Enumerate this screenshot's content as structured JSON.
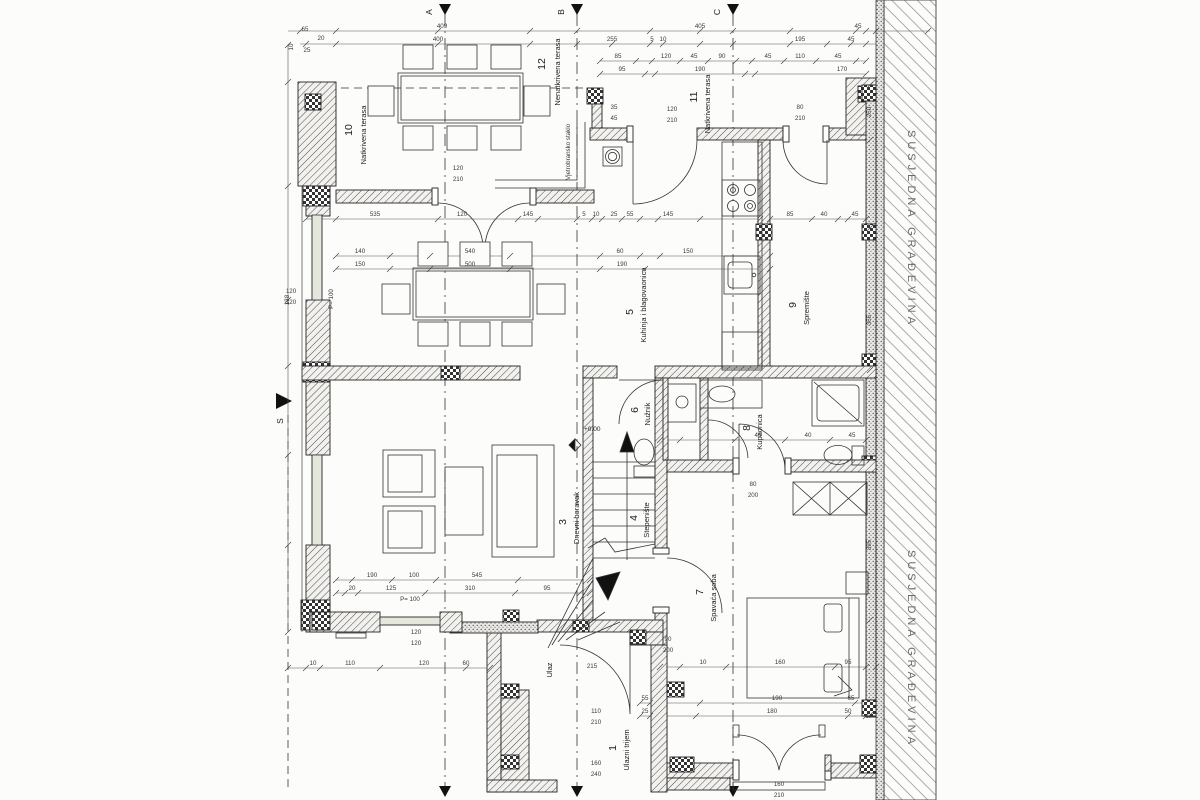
{
  "plan": {
    "neighbor_label": "SUSJEDNA GRAĐEVINA",
    "north_label": "S",
    "elevation_label": "+0.00",
    "entrance_label": "Ulaz",
    "section_markers": {
      "a": "A",
      "b": "B",
      "c": "C"
    },
    "rooms": [
      {
        "number": "10",
        "name": "Natkrivena terasa"
      },
      {
        "number": "12",
        "name": "Nenatkrivena terasa"
      },
      {
        "number": "11",
        "name": "Natkrivena terasa"
      },
      {
        "number": "5",
        "name": "Kuhinja i blagovaonica"
      },
      {
        "number": "9",
        "name": "Spremište"
      },
      {
        "number": "3",
        "name": "Dnevni boravak"
      },
      {
        "number": "6",
        "name": "Nužnik"
      },
      {
        "number": "4",
        "name": "Stepenište"
      },
      {
        "number": "8",
        "name": "Kupaonica"
      },
      {
        "number": "7",
        "name": "Spavaća soba"
      },
      {
        "number": "1",
        "name": "Ulazni trijem"
      }
    ],
    "annotations": [
      {
        "x": 442,
        "y": 28,
        "t": "409"
      },
      {
        "x": 700,
        "y": 28,
        "t": "405"
      },
      {
        "x": 858,
        "y": 28,
        "t": "45"
      },
      {
        "x": 438,
        "y": 41,
        "t": "400"
      },
      {
        "x": 612,
        "y": 41,
        "t": "255"
      },
      {
        "x": 652,
        "y": 41,
        "t": "5"
      },
      {
        "x": 663,
        "y": 41,
        "t": "10"
      },
      {
        "x": 800,
        "y": 41,
        "t": "195"
      },
      {
        "x": 851,
        "y": 41,
        "t": "45"
      },
      {
        "x": 305,
        "y": 31,
        "t": "65"
      },
      {
        "x": 321,
        "y": 40,
        "t": "20"
      },
      {
        "x": 307,
        "y": 52,
        "t": "25"
      },
      {
        "x": 293,
        "y": 47,
        "t": "10",
        "r": -90
      },
      {
        "x": 618,
        "y": 58,
        "t": "85"
      },
      {
        "x": 666,
        "y": 58,
        "t": "120"
      },
      {
        "x": 694,
        "y": 58,
        "t": "45"
      },
      {
        "x": 722,
        "y": 58,
        "t": "90"
      },
      {
        "x": 768,
        "y": 58,
        "t": "45"
      },
      {
        "x": 800,
        "y": 58,
        "t": "110"
      },
      {
        "x": 838,
        "y": 58,
        "t": "45"
      },
      {
        "x": 622,
        "y": 71,
        "t": "95"
      },
      {
        "x": 700,
        "y": 71,
        "t": "190"
      },
      {
        "x": 842,
        "y": 71,
        "t": "170"
      },
      {
        "x": 458,
        "y": 170,
        "t": "120"
      },
      {
        "x": 458,
        "y": 181,
        "t": "210"
      },
      {
        "x": 672,
        "y": 111,
        "t": "120"
      },
      {
        "x": 672,
        "y": 122,
        "t": "210"
      },
      {
        "x": 800,
        "y": 109,
        "t": "80"
      },
      {
        "x": 800,
        "y": 120,
        "t": "210"
      },
      {
        "x": 614,
        "y": 109,
        "t": "35"
      },
      {
        "x": 614,
        "y": 120,
        "t": "45"
      },
      {
        "x": 753,
        "y": 486,
        "t": "80"
      },
      {
        "x": 753,
        "y": 497,
        "t": "200"
      },
      {
        "x": 668,
        "y": 641,
        "t": "90"
      },
      {
        "x": 668,
        "y": 652,
        "t": "200"
      },
      {
        "x": 596,
        "y": 713,
        "t": "110"
      },
      {
        "x": 596,
        "y": 724,
        "t": "210"
      },
      {
        "x": 596,
        "y": 765,
        "t": "160"
      },
      {
        "x": 596,
        "y": 776,
        "t": "240"
      },
      {
        "x": 779,
        "y": 786,
        "t": "160"
      },
      {
        "x": 779,
        "y": 797,
        "t": "210"
      },
      {
        "x": 291,
        "y": 293,
        "t": "120"
      },
      {
        "x": 291,
        "y": 304,
        "t": "120"
      },
      {
        "x": 416,
        "y": 634,
        "t": "120"
      },
      {
        "x": 416,
        "y": 645,
        "t": "120"
      },
      {
        "x": 333,
        "y": 299,
        "t": "P= 100",
        "r": -90
      },
      {
        "x": 410,
        "y": 601,
        "t": "P= 100"
      },
      {
        "x": 375,
        "y": 216,
        "t": "535"
      },
      {
        "x": 462,
        "y": 216,
        "t": "120"
      },
      {
        "x": 528,
        "y": 216,
        "t": "145"
      },
      {
        "x": 584,
        "y": 216,
        "t": "5"
      },
      {
        "x": 596,
        "y": 216,
        "t": "10"
      },
      {
        "x": 614,
        "y": 216,
        "t": "25"
      },
      {
        "x": 630,
        "y": 216,
        "t": "55"
      },
      {
        "x": 668,
        "y": 216,
        "t": "145"
      },
      {
        "x": 790,
        "y": 216,
        "t": "85"
      },
      {
        "x": 824,
        "y": 216,
        "t": "40"
      },
      {
        "x": 855,
        "y": 216,
        "t": "45"
      },
      {
        "x": 360,
        "y": 253,
        "t": "140"
      },
      {
        "x": 470,
        "y": 253,
        "t": "540"
      },
      {
        "x": 620,
        "y": 253,
        "t": "60"
      },
      {
        "x": 688,
        "y": 253,
        "t": "150"
      },
      {
        "x": 360,
        "y": 266,
        "t": "150"
      },
      {
        "x": 470,
        "y": 266,
        "t": "500"
      },
      {
        "x": 622,
        "y": 266,
        "t": "190"
      },
      {
        "x": 372,
        "y": 577,
        "t": "190"
      },
      {
        "x": 414,
        "y": 577,
        "t": "100"
      },
      {
        "x": 477,
        "y": 577,
        "t": "545"
      },
      {
        "x": 352,
        "y": 590,
        "t": "20"
      },
      {
        "x": 391,
        "y": 590,
        "t": "125"
      },
      {
        "x": 470,
        "y": 590,
        "t": "310"
      },
      {
        "x": 547,
        "y": 590,
        "t": "95"
      },
      {
        "x": 313,
        "y": 665,
        "t": "10"
      },
      {
        "x": 350,
        "y": 665,
        "t": "110"
      },
      {
        "x": 424,
        "y": 665,
        "t": "120"
      },
      {
        "x": 466,
        "y": 665,
        "t": "60"
      },
      {
        "x": 592,
        "y": 668,
        "t": "215"
      },
      {
        "x": 703,
        "y": 664,
        "t": "10"
      },
      {
        "x": 780,
        "y": 664,
        "t": "160"
      },
      {
        "x": 848,
        "y": 664,
        "t": "95"
      },
      {
        "x": 645,
        "y": 700,
        "t": "55"
      },
      {
        "x": 777,
        "y": 700,
        "t": "190"
      },
      {
        "x": 851,
        "y": 700,
        "t": "65"
      },
      {
        "x": 645,
        "y": 713,
        "t": "25"
      },
      {
        "x": 772,
        "y": 713,
        "t": "180"
      },
      {
        "x": 848,
        "y": 713,
        "t": "50"
      },
      {
        "x": 758,
        "y": 437,
        "t": "45"
      },
      {
        "x": 808,
        "y": 437,
        "t": "40"
      },
      {
        "x": 852,
        "y": 437,
        "t": "45"
      },
      {
        "x": 871,
        "y": 112,
        "t": "250",
        "r": -90
      },
      {
        "x": 871,
        "y": 320,
        "t": "355",
        "r": -90
      },
      {
        "x": 871,
        "y": 545,
        "t": "395",
        "r": -90
      },
      {
        "x": 289,
        "y": 300,
        "t": "138",
        "r": -90
      },
      {
        "x": 570,
        "y": 152,
        "t": "Vjetrobransko staklo",
        "r": -90,
        "s": 4.6
      }
    ]
  }
}
